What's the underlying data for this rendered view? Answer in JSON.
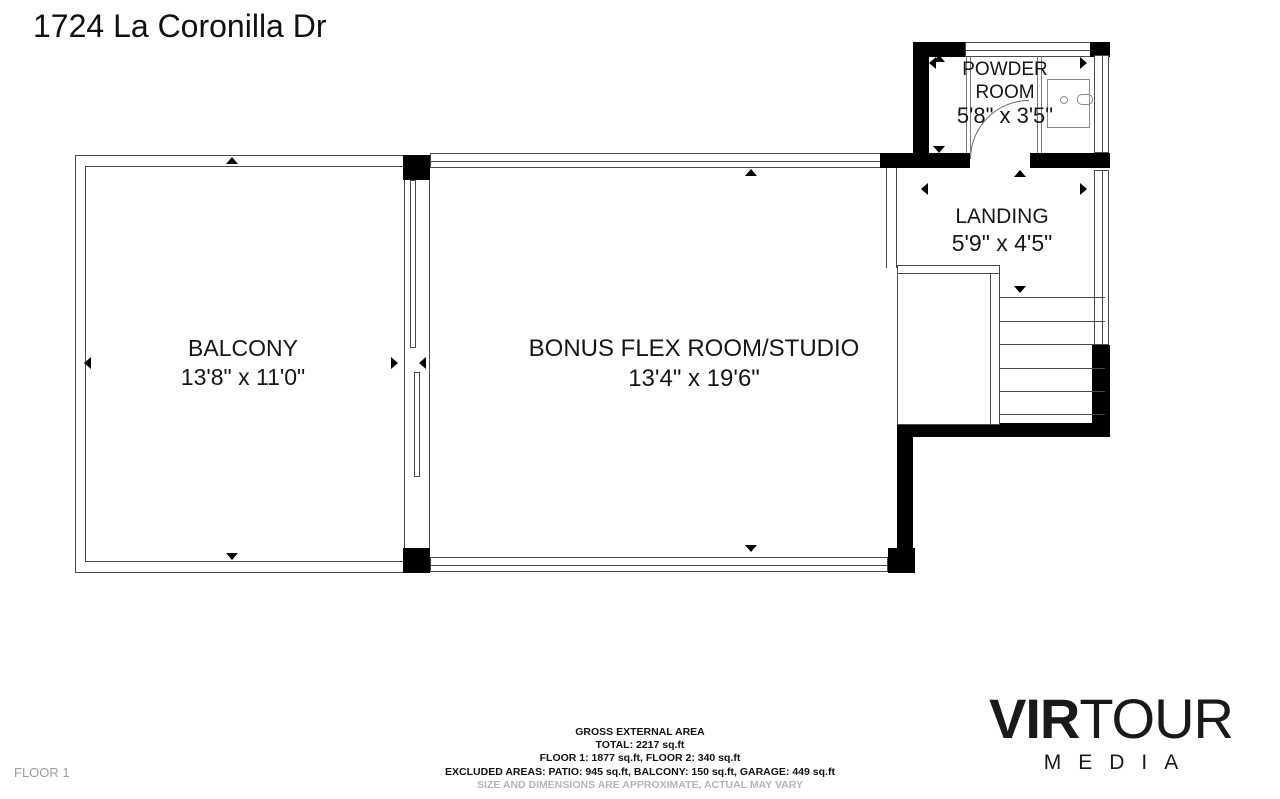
{
  "title": "1724 La Coronilla Dr",
  "floor_label": "FLOOR 1",
  "rooms": {
    "balcony": {
      "name": "BALCONY",
      "dimensions": "13'8\" x 11'0\""
    },
    "bonus": {
      "name": "BONUS FLEX ROOM/STUDIO",
      "dimensions": "13'4\" x 19'6\""
    },
    "powder": {
      "name_line1": "POWDER",
      "name_line2": "ROOM",
      "dimensions": "5'8\" x 3'5\""
    },
    "landing": {
      "name": "LANDING",
      "dimensions": "5'9\" x 4'5\""
    }
  },
  "area_summary": {
    "lines": [
      "GROSS EXTERNAL AREA",
      "TOTAL: 2217 sq.ft",
      "FLOOR 1: 1877 sq.ft, FLOOR 2: 340 sq.ft",
      "EXCLUDED AREAS: PATIO: 945 sq.ft, BALCONY: 150 sq.ft, GARAGE: 449 sq.ft"
    ],
    "disclaimer": "SIZE AND DIMENSIONS ARE APPROXIMATE, ACTUAL MAY VARY"
  },
  "logo": {
    "brand_bold": "VIR",
    "brand_light": "TOUR",
    "sub": "MEDIA"
  },
  "colors": {
    "wall": "#000000",
    "line": "#4a4a4a",
    "text": "#161616",
    "muted": "#b5b5b5"
  }
}
